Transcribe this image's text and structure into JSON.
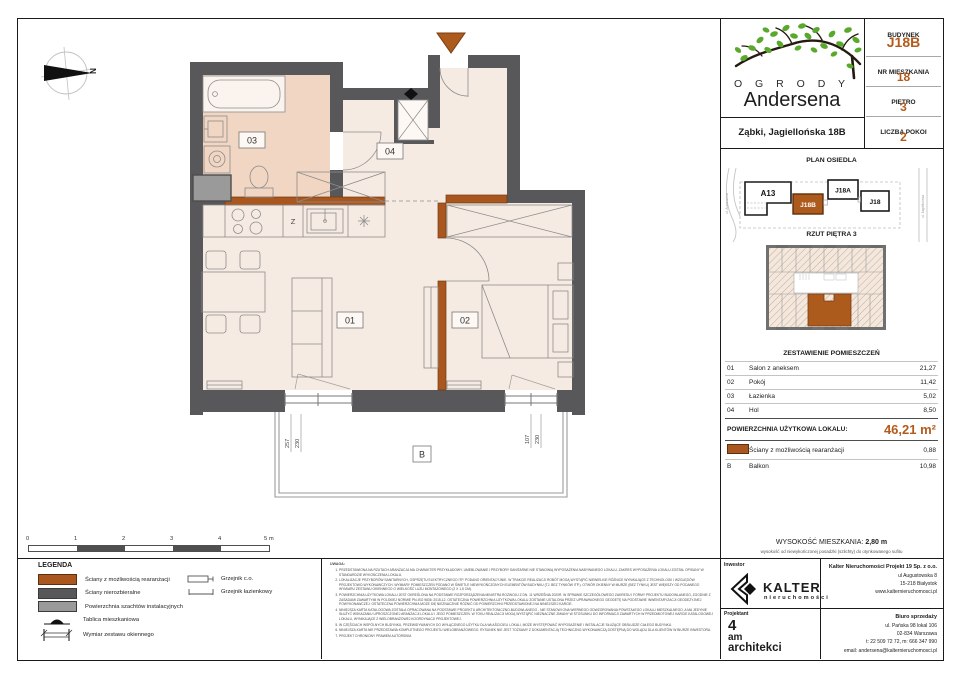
{
  "header": {
    "logo_line1": "O G R O D Y",
    "logo_line2": "Andersena",
    "address": "Ząbki, Jagiellońska 18B",
    "info": [
      {
        "label": "BUDYNEK",
        "value": "J18B"
      },
      {
        "label": "NR MIESZKANIA",
        "value": "18"
      },
      {
        "label": "PIĘTRO",
        "value": "3"
      },
      {
        "label": "LICZBA POKOI",
        "value": "2"
      }
    ]
  },
  "site_plan": {
    "title": "PLAN OSIEDLA",
    "buildings": [
      {
        "name": "A13",
        "highlight": false
      },
      {
        "name": "J18B",
        "highlight": true
      },
      {
        "name": "J18A",
        "highlight": false
      },
      {
        "name": "J18",
        "highlight": false
      }
    ],
    "streets": [
      "ul. Andersena",
      "ul. Jagiellońska"
    ]
  },
  "floor_thumb": {
    "title": "RZUT PIĘTRA 3"
  },
  "rooms_table": {
    "title": "ZESTAWIENIE POMIESZCZEŃ",
    "rows": [
      {
        "id": "01",
        "name": "Salon z aneksem",
        "area": "21,27"
      },
      {
        "id": "02",
        "name": "Pokój",
        "area": "11,42"
      },
      {
        "id": "03",
        "name": "Łazienka",
        "area": "5,02"
      },
      {
        "id": "04",
        "name": "Hol",
        "area": "8,50"
      }
    ],
    "total_label": "POWIERZCHNIA UŻYTKOWA LOKALU:",
    "total_value": "46,21 m²",
    "extra": [
      {
        "id": "",
        "name": "Ściany z możliwością rearanżacji",
        "area": "0,88"
      },
      {
        "id": "B",
        "name": "Balkon",
        "area": "10,98"
      }
    ]
  },
  "height_info": {
    "label": "WYSOKOŚĆ MIESZKANIA:",
    "value": "2,80 m",
    "subtitle": "wysokość od niewykończonej posadzki (szlichty) do otynkowanego sufitu"
  },
  "footer": {
    "investor_label": "Inwestor",
    "brand_name": "KALTER",
    "brand_sub": "nieruchomości",
    "company": {
      "name": "Kalter Nieruchomości Projekt 19 Sp. z o.o.",
      "line1": "ul Augustowska 8",
      "line2": "15-218 Białystok",
      "line3": "www.kalternieruchomosci.pl"
    },
    "designer_label": "Projektant",
    "designer": {
      "l1": "4",
      "l2": "am",
      "l3": "architekci"
    },
    "sales": {
      "title": "Biuro sprzedaży",
      "line1": "ul. Pańska 98 lokal 106",
      "line2": "02-834 Warszawa",
      "line3": "t: 22 509 72 72, m: 666 347 990",
      "line4": "email: andersena@kalternieruchomosci.pl"
    }
  },
  "legend": {
    "title": "LEGENDA",
    "items": [
      {
        "label": "Ściany z możliwością rearanżacji",
        "swatch": "#a9571e"
      },
      {
        "label": "Ściany nierozbieralne",
        "swatch": "#58585a"
      },
      {
        "label": "Powierzchnia szachtów instalacyjnych",
        "swatch": "#9a9a9a"
      },
      {
        "label": "Tablica mieszkaniowa",
        "swatch": "icon-board"
      },
      {
        "label": "Wymiar zestawu okiennego",
        "swatch": "icon-window-dim"
      }
    ],
    "items_right": [
      {
        "label": "Grzejnik c.o.",
        "icon": "radiator-co-icon"
      },
      {
        "label": "Grzejnik łazienkowy",
        "icon": "radiator-bath-icon"
      }
    ]
  },
  "notes": {
    "title": "UWAGA:",
    "items": [
      "PRZEDSTAWIONA NA RZUTACH ARANŻACJA MA CHARAKTER PRZYKŁADOWY. UMEBLOWANIE I PRZYBORY SANITARNE NIE STANOWIĄ WYPOSAŻENIA NABYWANEGO LOKALU. ZAKRES WYPOSAŻENIA LOKALU ZOSTAŁ OPISANY W STANDARDZIE WYKOŃCZENIA LOKALU.",
      "LOKALIZACJE PRZYBORÓW SANITARNYCH, OSPRZĘTU ELEKTRYCZNEGO ITP. PODANO ORIENTACYJNIE. W TRAKCIE REALIZACJI ROBÓT MOGĄ WYSTĄPIĆ NIEWIELKIE RÓŻNICE WYNIKAJĄCE Z TECHNOLOGII I WZGLĘDÓW PROJEKTOWO-WYKONAWCZYCH. WYMIARY POMIESZCZEŃ PODANO W ŚWIETLE NIEWYKOŃCZONYCH ELEMENTÓW BUDYNKU (TJ. BEZ TYNKÓW ITP.). OTWÓR OKIENNY W MURZE (BEZ TYNKU) JEST WIĘKSZY OD PODANEGO WYMIARU ZESTAWU OKIENNEGO O WIELKOŚĆ LUZU MONTAŻOWEGO (2 X 1,5 CM).",
      "POWIERZCHNIA UŻYTKOWA LOKALU JEST OKREŚLONA NA PODSTAWIE ROZPORZĄDZENIA MINISTRA ROZWOJU Z DN. 11 WRZEŚNIA 2020R. W SPRAWIE SZCZEGÓŁOWEGO ZAKRESU I FORMY PROJEKTU BUDOWLANEGO, ZGODNIE Z ZASADAMI ZAWARTYMI W POLSKIEJ NORMIE PN-ISO 9836: 2015-12. OSTATECZNA POWIERZCHNIA UŻYTKOWA LOKALU ZOSTANIE USTALONA PRZEZ UPRAWNIONEGO GEODETĘ NA PODSTAWIE INWENTARYZACJI GEODEZYJNEJ POWYKONAWCZEJ. OSTATECZNA POWIERZCHNIA MOŻE SIĘ NIEZNACZNIE RÓŻNIĆ OD POWIERZCHNI PRZEDSTAWIONEJ NA NINIEJSZEJ KARCIE.",
      "NINIEJSZA KARTA KATALOGOWA ZOSTAŁA OPRACOWANA NA PODSTAWIE PROJEKTU ARCHITEKTONICZNO-BUDOWLANEGO - NIE STANOWI ONA WIERNEGO ODWZOROWANIA POWSTAŁEGO LOKALU MIESZKALNEGO, A MA JEDYNIE SŁUŻYĆ WSKAZANIU UPROSZCZONEJ ARANŻACJI LOKALU I JEGO POMIESZCZEŃ. W TOKU REALIZACJI MOGĄ WYSTĄPIĆ NIEZNACZNE ZMIANY W STOSUNKU DO INFORMACJI ZAWARTYCH W PRZEDMIOTOWEJ KARCIE KATALOGOWEJ LOKALU, WYNIKAJĄCE Z WIELOBRANŻOWEJ KOORDYNACJI PROJEKTOWEJ.",
      "W CZĘŚCIACH WSPÓLNYCH BUDYNKU, PRZEWIDYWANYCH DO WYŁĄCZNEGO UŻYTKU DLA WŁAŚCICIELI LOKALI, MOŻE WYSTĘPOWAĆ WYPOSAŻENIE I INSTALACJE SŁUŻĄCE OBSŁUDZE CAŁEGO BUDYNKU.",
      "NINIEJSZA KARTA NIE PRZEDSTAWIA KOMPLETNEGO PROJEKTU WIELOBRANŻOWEGO. RYSUNEK NIE JEST TOŻSAMY Z DOKUMENTACJĄ TECHNICZNO-WYKONAWCZĄ DOSTĘPNĄ DO WGLĄDU DLA KLIENTÓW W BIURZE INWESTORA.",
      "PROJEKT CHRONIONY PRAWEM AUTORSKIM."
    ]
  },
  "scalebar": {
    "labels": [
      "0",
      "1",
      "2",
      "3",
      "4",
      "5 m"
    ]
  },
  "plan": {
    "room_labels": {
      "r01": "01",
      "r02": "02",
      "r03": "03",
      "r04": "04",
      "balcony": "B",
      "kitchen_z": "Z"
    },
    "dims": {
      "win1_w": "257",
      "win1_h": "230",
      "win2_w": "107",
      "win2_h": "230"
    },
    "north": "N"
  },
  "colors": {
    "accent": "#b45a1a",
    "wall": "#58585a",
    "wall_reconfig": "#a9571e",
    "shaft": "#9a9a9a",
    "room_fill": "#f6ebe3",
    "bath_fill": "#f0d6c3",
    "leaf_green": "#5aa82c"
  }
}
